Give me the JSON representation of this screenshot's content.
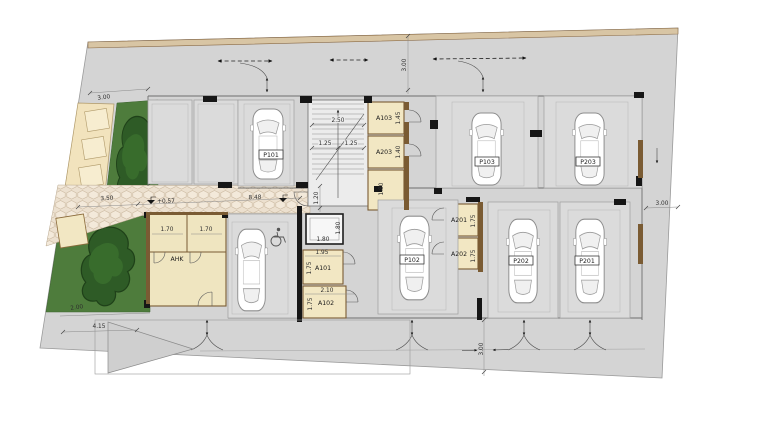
{
  "plan": {
    "parking": {
      "p101": "P101",
      "p102": "P102",
      "p103": "P103",
      "p201": "P201",
      "p202": "P202",
      "p203": "P203"
    },
    "storage": {
      "a101": "A101",
      "a102": "A102",
      "a103": "A103",
      "a201": "A201",
      "a202": "A202",
      "a203": "A203",
      "ahk": "AHK"
    },
    "dims": {
      "plot_top_left": "3.00",
      "plot_top_center": "3.00",
      "plot_right": "3.00",
      "plot_bottom_center": "3.00",
      "walkway_left": "3.50",
      "walkway_level": "+0.57",
      "walkway_right": "8.48",
      "stair_total_width": "2.50",
      "stair_flight_left": "1.25",
      "stair_flight_right": "1.25",
      "stair_hall_width": "1.20",
      "a103_depth": "1.45",
      "a203_depth": "1.40",
      "store_depth": "1.80",
      "lift_width": "1.80",
      "lift_depth": "1.80",
      "a101_width": "1.95",
      "a101_depth": "1.75",
      "a102_width": "2.10",
      "a102_depth": "1.75",
      "ahk_left_width": "1.70",
      "ahk_right_width": "1.70",
      "a201_depth": "1.75",
      "a202_depth": "1.75",
      "ramp_length": "4.15",
      "green_strip": "2.00"
    },
    "colors": {
      "ground_gray": "#d4d4d4",
      "room_tan": "#f2e7c3",
      "wall_brown": "#7a5b33",
      "wall_black": "#161616",
      "paver_beige": "#ece0cf",
      "lawn_green": "#4e7c3c",
      "tree_green": "#2e5b26",
      "boundary_tan": "#d8c5a4"
    },
    "icons": {
      "wheelchair": "accessible-parking-icon",
      "level_marker": "level-benchmark-icon"
    }
  }
}
